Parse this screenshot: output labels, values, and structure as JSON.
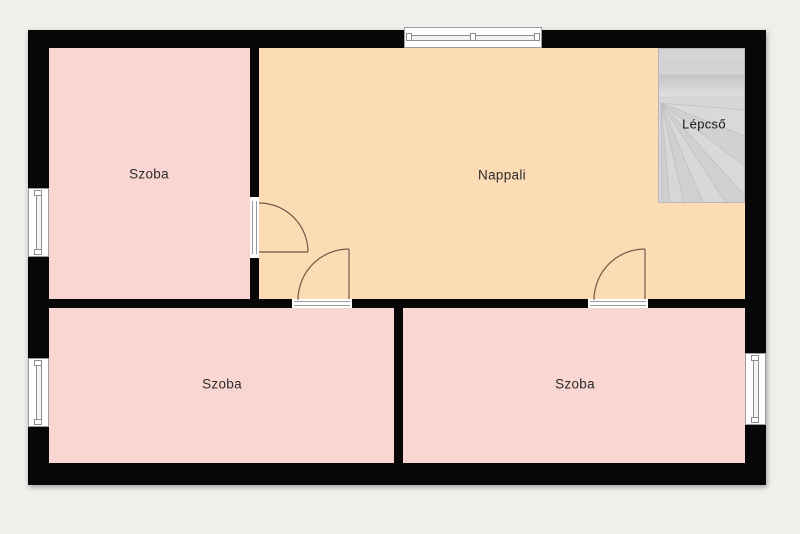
{
  "rooms": [
    {
      "id": "szoba-top-left",
      "label": "Szoba"
    },
    {
      "id": "nappali",
      "label": "Nappali"
    },
    {
      "id": "szoba-bottom-left",
      "label": "Szoba"
    },
    {
      "id": "szoba-bottom-right",
      "label": "Szoba"
    },
    {
      "id": "lepcso",
      "label": "Lépcső"
    }
  ],
  "colors": {
    "background": "#f1efec",
    "wall": "#070707",
    "room_pink": "#f9d6d2",
    "room_living": "#fbdcb4",
    "stairs": "#d6d6d6",
    "door_arc": "#6e5a49",
    "window_frame": "#9c9c9c",
    "label_text": "#2b2b2b"
  }
}
